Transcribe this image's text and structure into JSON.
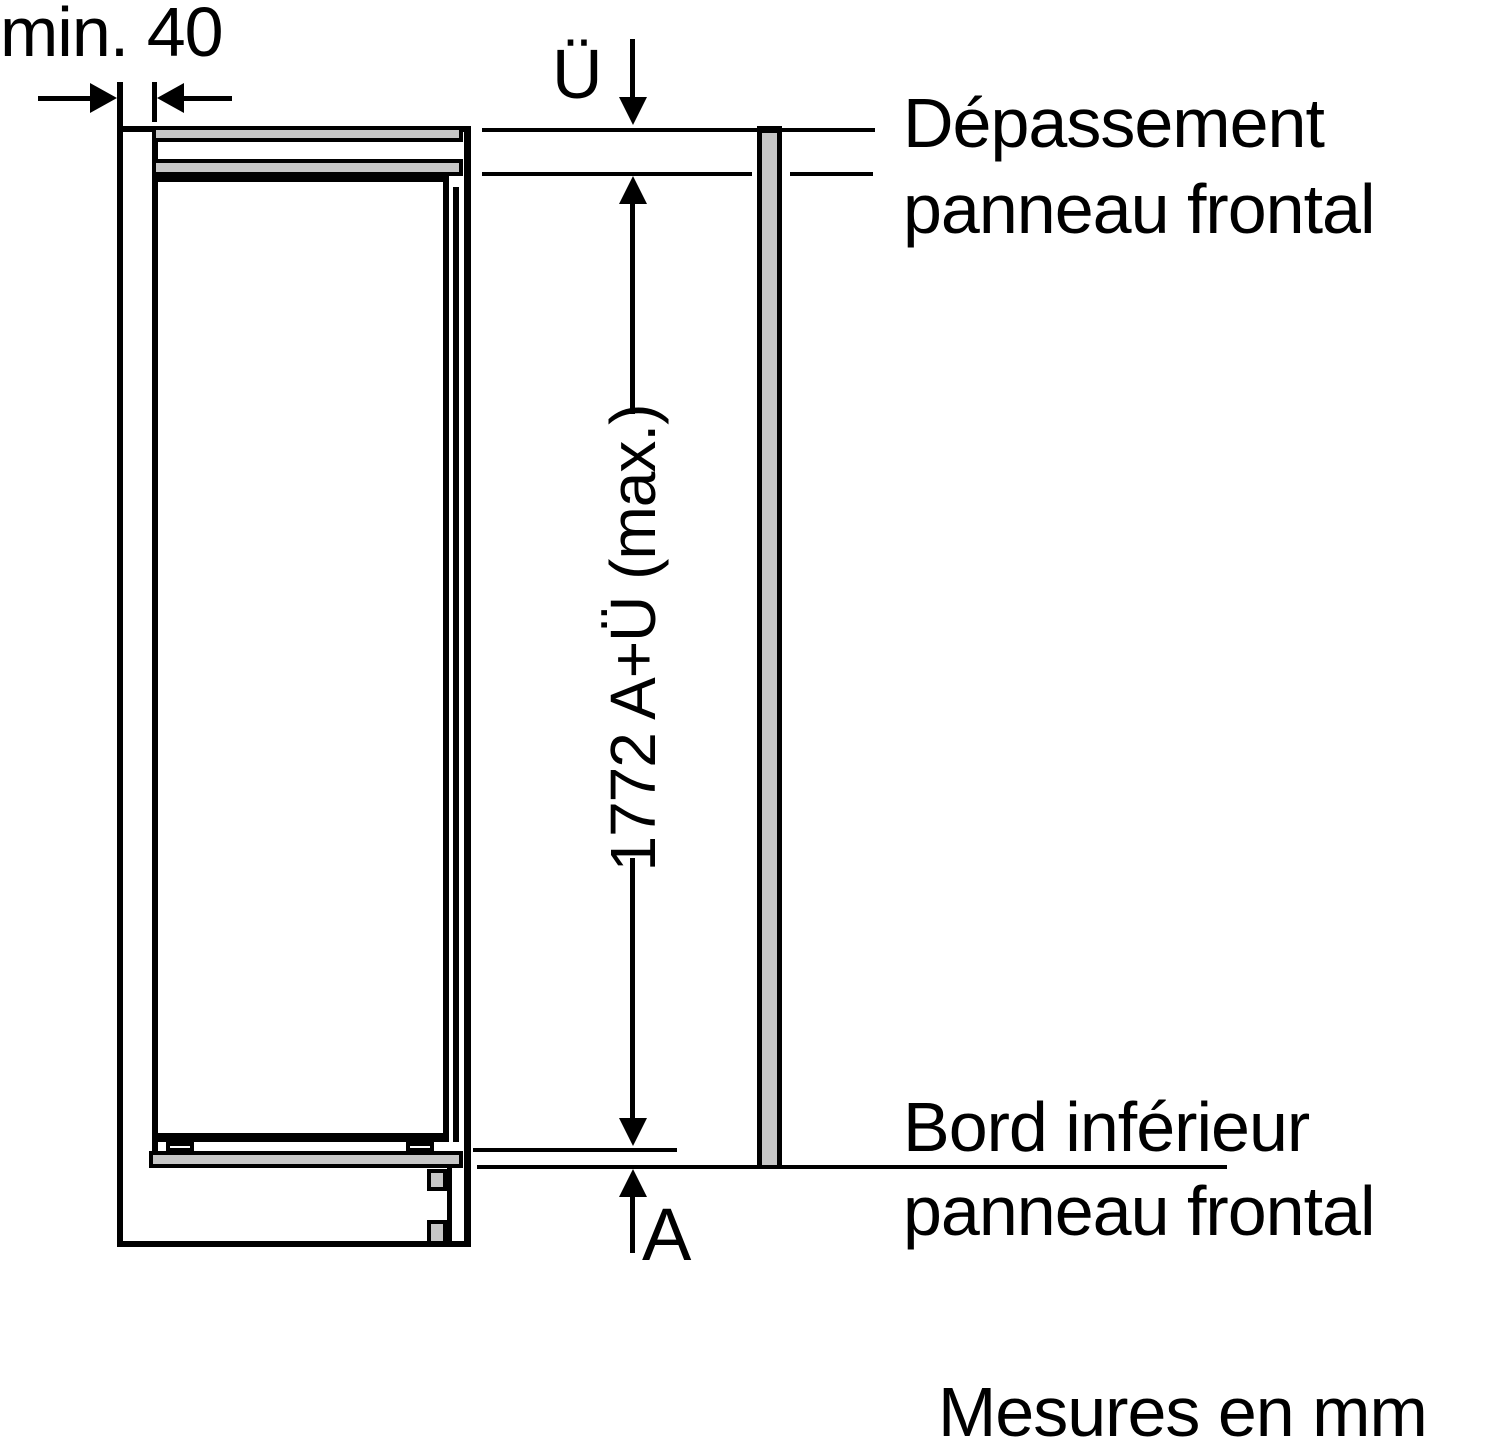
{
  "diagram": {
    "title_implicit": "Installation drawing - built-in appliance front panel",
    "unit_note": "Mesures en mm",
    "dimensions": {
      "min_gap": "min. 40",
      "overhang_symbol": "Ü",
      "height_dimension": "1772 A+Ü (max.)",
      "bottom_offset_symbol": "A"
    },
    "annotations": {
      "top_label_line1": "Dépassement",
      "top_label_line2": "panneau frontal",
      "bottom_label_line1": "Bord inférieur",
      "bottom_label_line2": "panneau frontal"
    },
    "colors": {
      "line": "#000000",
      "fill_gray": "#c6c6c6",
      "background": "#ffffff"
    }
  }
}
